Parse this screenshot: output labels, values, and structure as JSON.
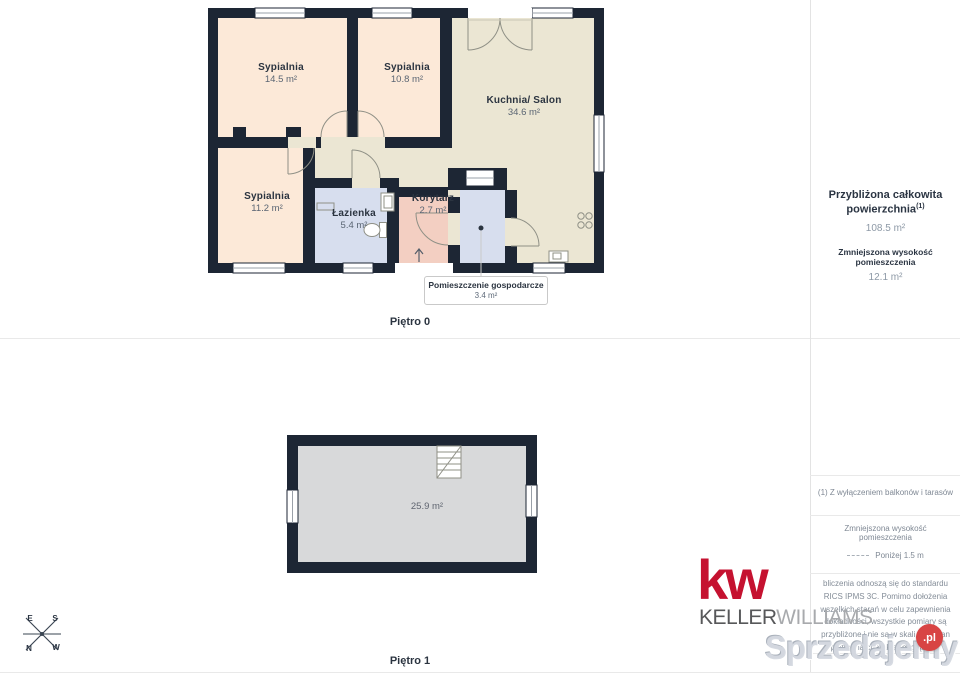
{
  "floor0": {
    "label": "Piętro 0",
    "rooms": [
      {
        "name": "Sypialnia",
        "area": "14.5 m²"
      },
      {
        "name": "Sypialnia",
        "area": "10.8 m²"
      },
      {
        "name": "Kuchnia/ Salon",
        "area": "34.6 m²"
      },
      {
        "name": "Sypialnia",
        "area": "11.2 m²"
      },
      {
        "name": "Łazienka",
        "area": "5.4 m²"
      },
      {
        "name": "Korytarz",
        "area": "2.7 m²"
      }
    ],
    "callout": {
      "name": "Pomieszczenie gospodarcze",
      "area": "3.4 m²"
    }
  },
  "floor1": {
    "label": "Piętro 1",
    "area": "25.9 m²"
  },
  "sidebar": {
    "total_title": "Przybliżona całkowita powierzchnia",
    "total_sup": "(1)",
    "total_value": "108.5 m²",
    "reduced_title": "Zmniejszona wysokość pomieszczenia",
    "reduced_value": "12.1 m²",
    "footnote": "(1) Z wyłączeniem balkonów i tarasów",
    "legend_title": "Zmniejszona wysokość pomieszczenia",
    "legend_value": "Poniżej 1.5 m",
    "disclaimer": "bliczenia odnoszą się do standardu RICS IPMS 3C. Pomimo dołożenia wszelkich starań w celu zapewnienia dokładności, wszystkie pomiary są przybliżone i nie są w skali. Ten plan piętra ma charakter poglądowy"
  },
  "branding": {
    "logo": "kw",
    "keller": "KELLER",
    "williams": "WILLIAMS"
  },
  "watermark": {
    "text": "Sprzedajemy",
    "suffix": ".pl"
  },
  "compass": {
    "e": "E",
    "s": "S",
    "n": "N",
    "w": "W"
  },
  "colors": {
    "wall": "#1d2634",
    "bedroom_fill": "#fce9d8",
    "kitchen_fill": "#ebe6d3",
    "bathroom_fill": "#d7deee",
    "corridor_fill": "#f3cfc2",
    "attic_fill": "#d8d9da",
    "kw_red": "#c51230",
    "watermark_red": "#d84444"
  }
}
